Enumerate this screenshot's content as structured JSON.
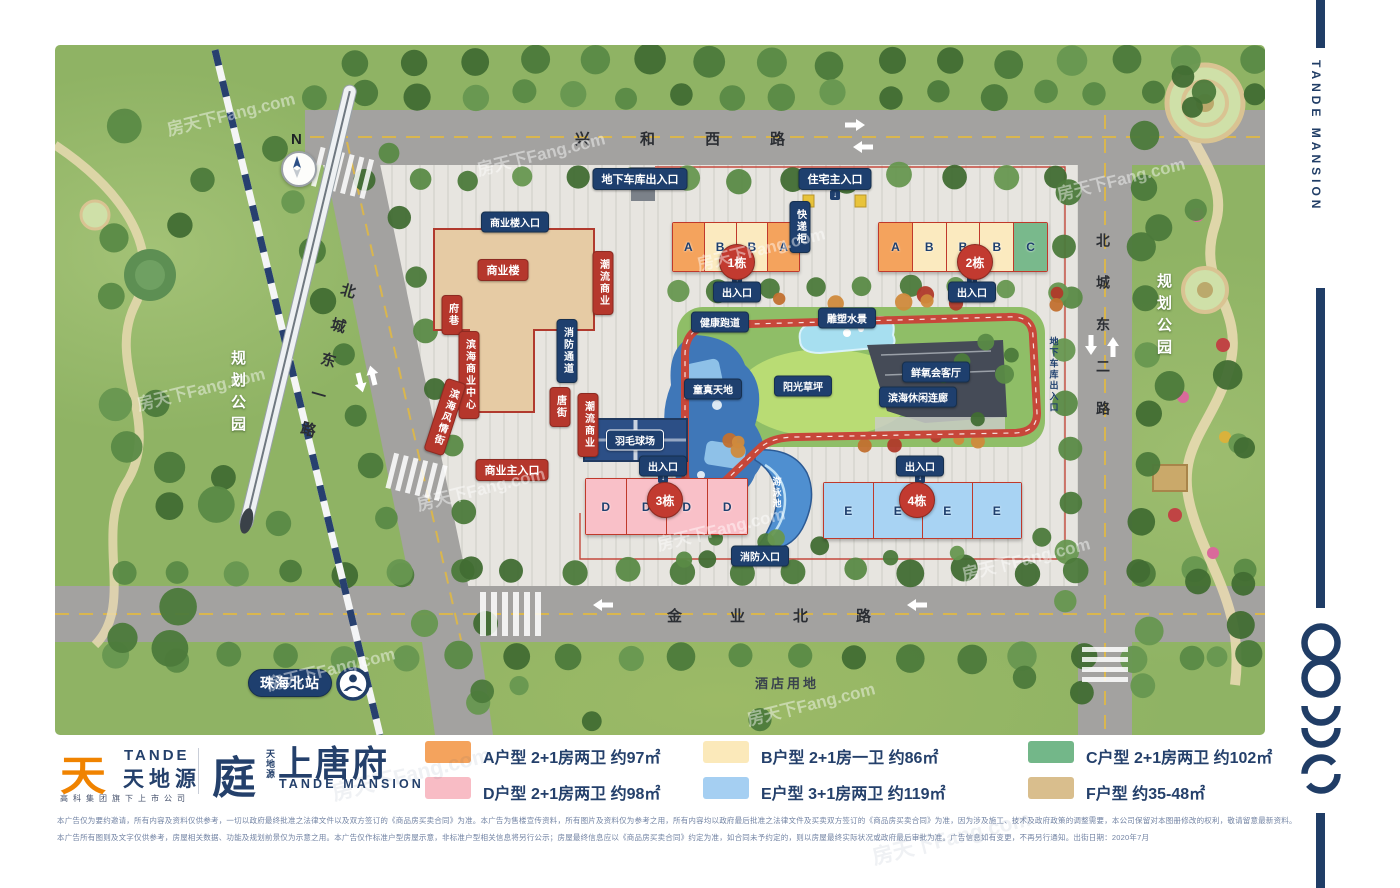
{
  "watermark": "房天下Fang.com",
  "map": {
    "north": "N",
    "roads": {
      "top": "兴和西路",
      "left_diag": "北城东一路",
      "right": "北城东二路",
      "bottom": "金业北路"
    },
    "parks": {
      "left": "规划公园",
      "right": "规划公园"
    },
    "station": {
      "name": "珠海北站"
    },
    "hotel_land": "酒店用地",
    "labels": {
      "underground_garage_entry": "地下车库出入口",
      "residential_main_entry": "住宅主入口",
      "commercial_bldg_entry": "商业楼入口",
      "commercial_bldg": "商业楼",
      "fu_alley": "府巷",
      "binhai_commercial_center": "滨海商业中心",
      "binhai_style_street": "滨海风情街",
      "fire_lane": "消防通道",
      "tang_street": "唐街",
      "trend_commercial": "潮流商业",
      "commercial_main_entry": "商业主入口",
      "express_lockers": "快递柜",
      "entrance_exit": "出入口",
      "fire_entry": "消防入口",
      "health_track": "健康跑道",
      "sculpture_water": "雕塑水景",
      "kids_world": "童真天地",
      "sunshine_lawn": "阳光草坪",
      "oxygen_lounge": "鲜氧会客厅",
      "leisure_corridor": "滨海休闲连廊",
      "badminton_court": "羽毛球场",
      "swimming_pool": "游泳池",
      "garage_entry_right": "地下车库出入口",
      "up_arrow": "↑",
      "down_arrow": "↓"
    },
    "buildings": [
      {
        "name": "1栋",
        "units": [
          "A",
          "B",
          "B",
          "A"
        ]
      },
      {
        "name": "2栋",
        "units": [
          "A",
          "B",
          "B",
          "B",
          "C"
        ]
      },
      {
        "name": "3栋",
        "units": [
          "D",
          "D",
          "D",
          "D"
        ]
      },
      {
        "name": "4栋",
        "units": [
          "E",
          "E",
          "E",
          "E"
        ]
      }
    ]
  },
  "legend": {
    "items": [
      {
        "type": "A",
        "color": "#f4a35d",
        "label": "A户型 2+1房两卫 约97㎡"
      },
      {
        "type": "B",
        "color": "#fbe9ba",
        "label": "B户型 2+1房一卫 约86㎡"
      },
      {
        "type": "C",
        "color": "#73b789",
        "label": "C户型 2+1房两卫 约102㎡"
      },
      {
        "type": "D",
        "color": "#f8bcc5",
        "label": "D户型 2+1房两卫 约98㎡"
      },
      {
        "type": "E",
        "color": "#a5cff2",
        "label": "E户型 3+1房两卫 约119㎡"
      },
      {
        "type": "F",
        "color": "#d9be8d",
        "label": "F户型 约35-48㎡"
      }
    ]
  },
  "brand": {
    "group_logo_char": "天",
    "group_en": "TANDE",
    "group_cn": "天地源",
    "group_tagline": "高科集团旗下上市公司",
    "mark_char": "庭",
    "project_small_cn": "天地源",
    "project_cn": "上唐府",
    "project_en": "TANDE MANSION",
    "navy": "#24406b",
    "orange": "#f08300"
  },
  "sidebar": {
    "vertical_en": "TANDE MANSION"
  },
  "disclaimer": {
    "line1": "本广告仅为要约邀请，所有内容及资料仅供参考，一切以政府最终批准之法律文件以及双方签订的《商品房买卖合同》为准。本广告为售楼宣传资料，所有图片及资料仅为参考之用，所有内容均以政府最后批准之法律文件及买卖双方签订的《商品房买卖合同》为准，因为涉及施工、技术及政府政策的调整需要，本公司保留对本图册修改的权利，敬请留意最新资料。",
    "line2": "本广告所有图则及文字仅供参考，房屋相关数据、功能及规划前景仅为示意之用。本广告仅作标准户型房屋示意，非标准户型相关信息将另行公示；房屋最终信息应以《商品房买卖合同》约定为准，如合同未予约定的，则以房屋最终实际状况或政府最后审批为准。广告信息如有变更，不再另行通知。出街日期：2020年7月"
  }
}
